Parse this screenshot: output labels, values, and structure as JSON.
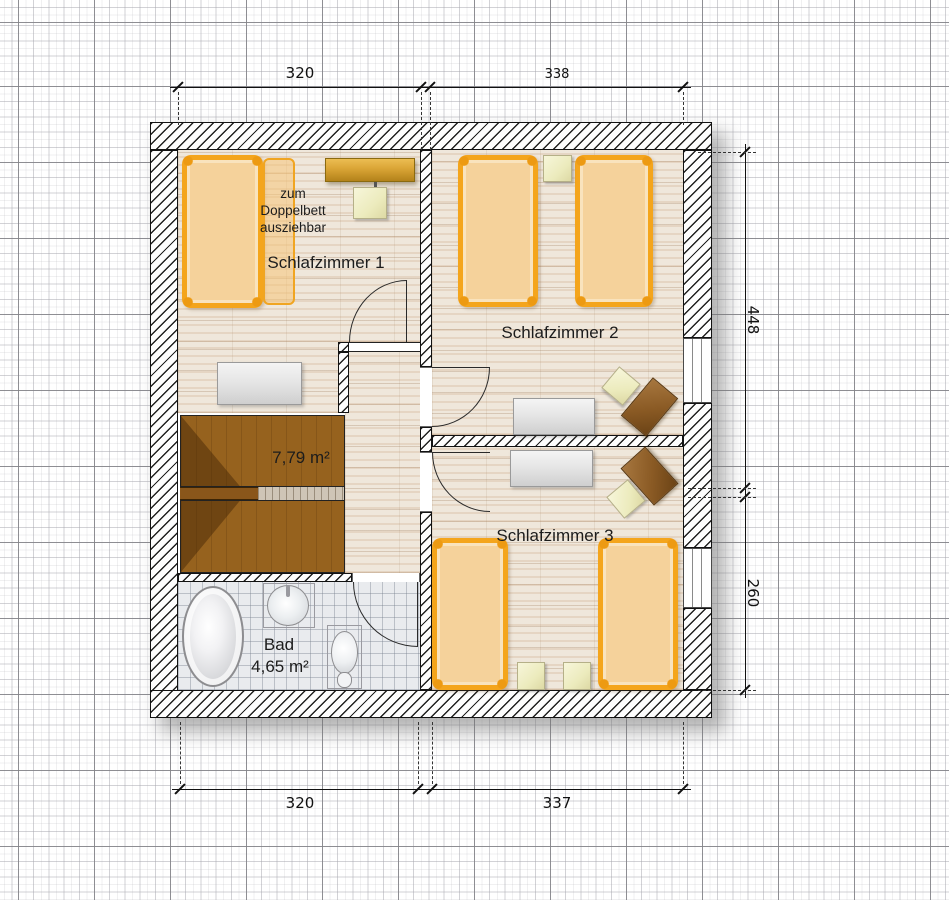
{
  "rooms": {
    "schlafzimmer1": {
      "label": "Schlafzimmer 1",
      "note": "zum\nDoppelbett\nausziehbar"
    },
    "schlafzimmer2": {
      "label": "Schlafzimmer 2"
    },
    "schlafzimmer3": {
      "label": "Schlafzimmer 3"
    },
    "stairwell": {
      "area": "7,79 m²"
    },
    "bathroom": {
      "label": "Bad",
      "area": "4,65 m²"
    }
  },
  "dimensions_cm": {
    "top": [
      "320",
      "338"
    ],
    "bottom": [
      "320",
      "337"
    ],
    "right": [
      "448",
      "260"
    ]
  },
  "colors": {
    "bed_frame": "#F4A51C",
    "mattress": "#F5D29B",
    "sideboard": "#D9A435",
    "chair_cream": "#F1F0CB",
    "desk_gray": "#E3E3E3",
    "furniture_brown": "#8A5A24",
    "stairs_brown": "#96621E",
    "wood_floor": "#EFE7DB",
    "bath_tile": "#E9EBEE",
    "wall_line": "#1A1A1A"
  }
}
